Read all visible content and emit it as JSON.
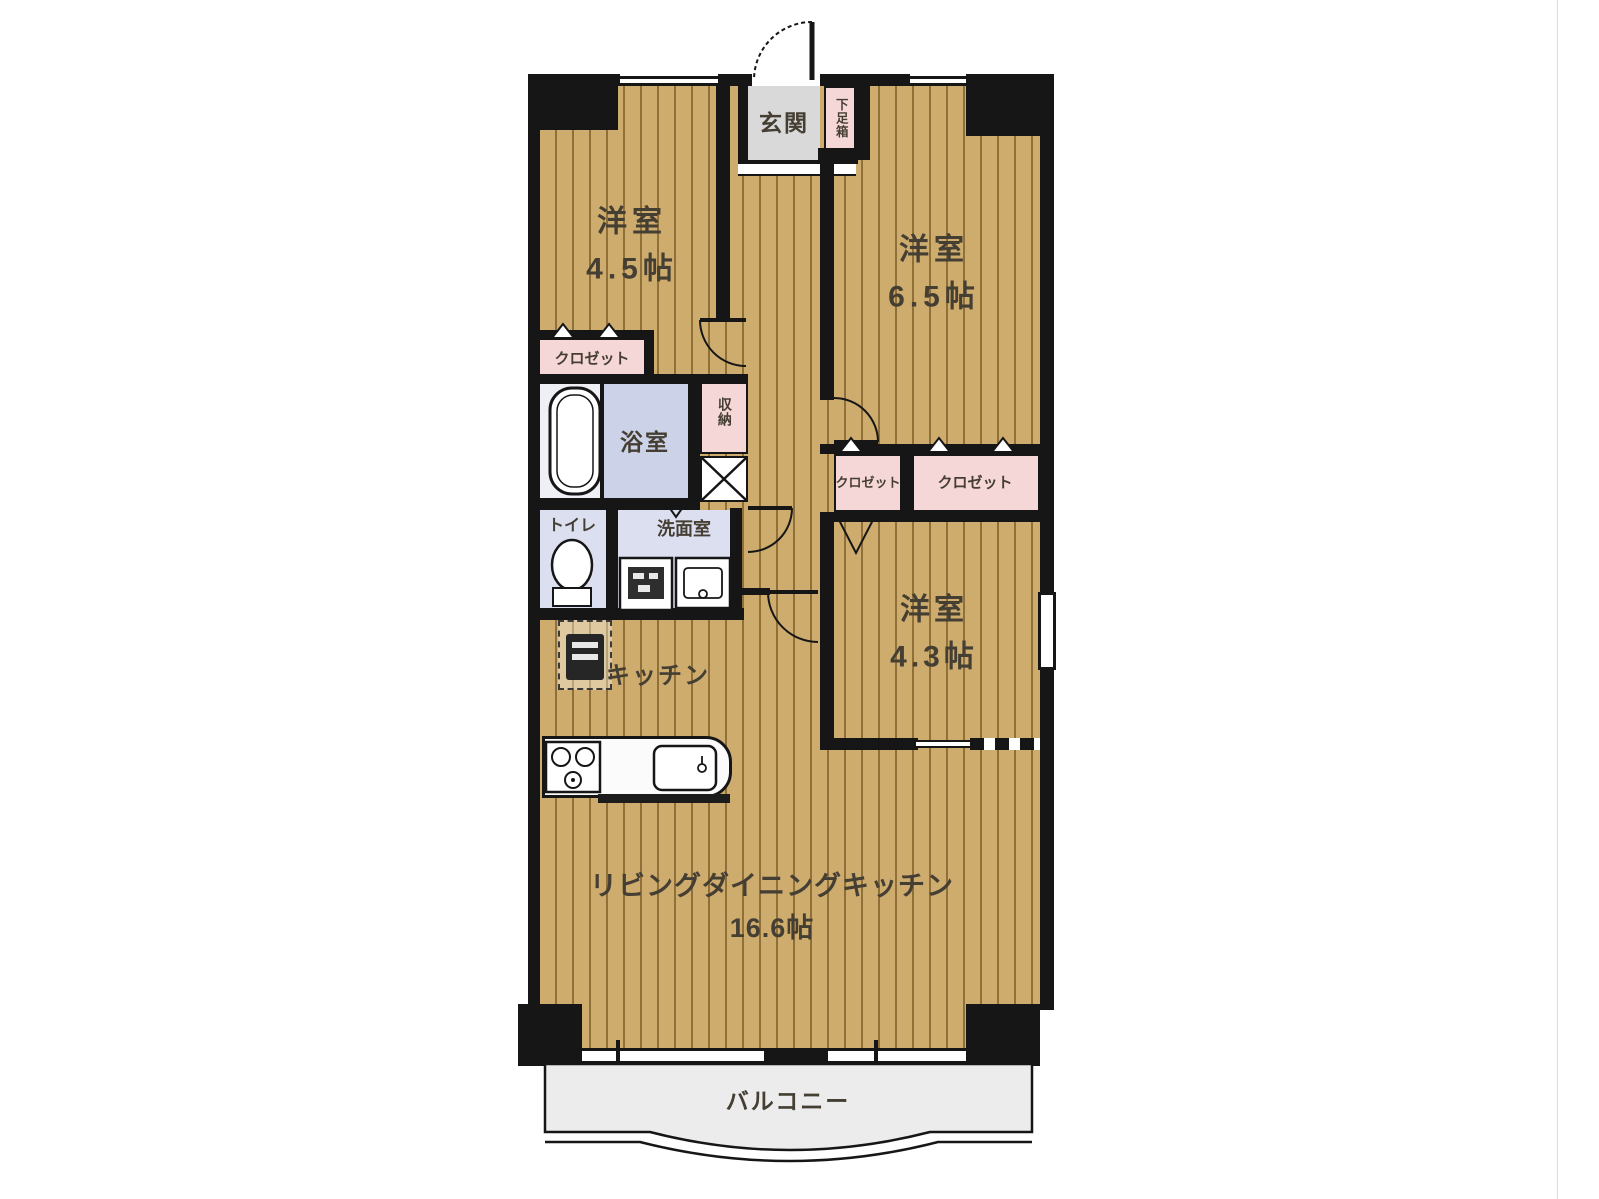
{
  "colors": {
    "wall": "#161616",
    "wood": "#cdac6e",
    "wood-stripe": "#8f7038",
    "pink": "#f6d7d7",
    "lav": "#dbdff0",
    "bath": "#ccd3e9",
    "genkan": "#d9d9d9",
    "balcony": "#ececec",
    "text": "#453e33"
  },
  "rooms": {
    "r45": {
      "name": "洋室",
      "size": "4.5帖"
    },
    "r65": {
      "name": "洋室",
      "size": "6.5帖"
    },
    "r43": {
      "name": "洋室",
      "size": "4.3帖"
    },
    "ldk": {
      "name": "リビングダイニングキッチン",
      "size": "16.6帖"
    }
  },
  "labels": {
    "genkan": "玄関",
    "shoe_cabinet": "下足箱",
    "bath": "浴室",
    "storage": "収納",
    "toilet": "トイレ",
    "washroom": "洗面室",
    "kitchen": "キッチン",
    "closet": "クロゼット",
    "balcony": "バルコニー"
  }
}
